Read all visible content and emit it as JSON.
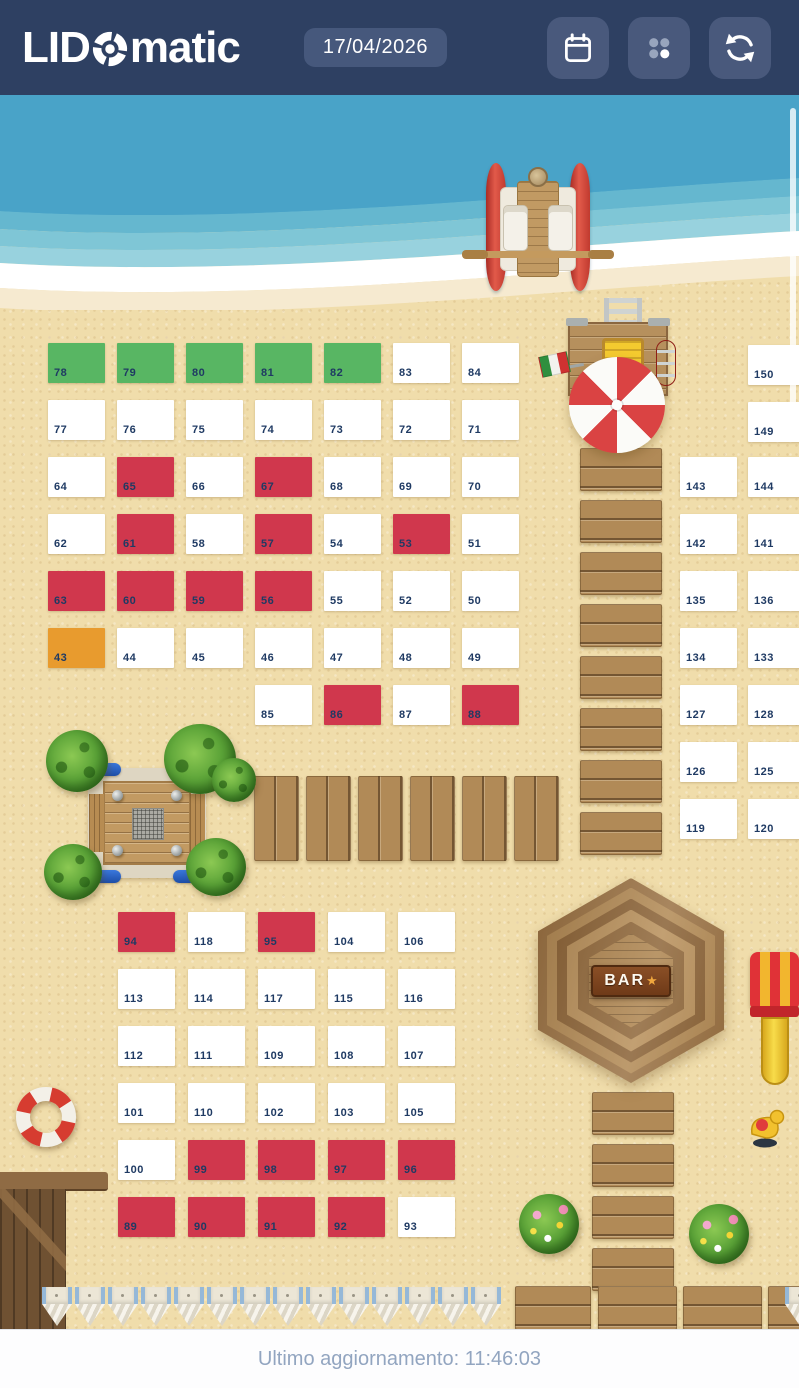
{
  "header": {
    "logo_prefix": "LID",
    "logo_suffix": "matic",
    "date": "17/04/2026",
    "buttons": [
      {
        "name": "calendar",
        "icon": "calendar-icon"
      },
      {
        "name": "grid-menu",
        "icon": "dots-grid-icon"
      },
      {
        "name": "refresh",
        "icon": "refresh-icon"
      }
    ]
  },
  "footer": {
    "last_update": "Ultimo aggiornamento: 11:46:03"
  },
  "bar": {
    "label": "BAR",
    "star": "★"
  },
  "colors": {
    "white": "#ffffff",
    "green": "#58b663",
    "red": "#d0374d",
    "orange": "#e89b2e",
    "header_bg": "#2e4062",
    "sand": "#f0ddab",
    "cell_text": "#1f3a63"
  },
  "map": {
    "cells": [
      {
        "n": "78",
        "x": 48,
        "y": 343,
        "s": "green"
      },
      {
        "n": "79",
        "x": 117,
        "y": 343,
        "s": "green"
      },
      {
        "n": "80",
        "x": 186,
        "y": 343,
        "s": "green"
      },
      {
        "n": "81",
        "x": 255,
        "y": 343,
        "s": "green"
      },
      {
        "n": "82",
        "x": 324,
        "y": 343,
        "s": "green"
      },
      {
        "n": "83",
        "x": 393,
        "y": 343,
        "s": "white"
      },
      {
        "n": "84",
        "x": 462,
        "y": 343,
        "s": "white"
      },
      {
        "n": "77",
        "x": 48,
        "y": 400,
        "s": "white"
      },
      {
        "n": "76",
        "x": 117,
        "y": 400,
        "s": "white"
      },
      {
        "n": "75",
        "x": 186,
        "y": 400,
        "s": "white"
      },
      {
        "n": "74",
        "x": 255,
        "y": 400,
        "s": "white"
      },
      {
        "n": "73",
        "x": 324,
        "y": 400,
        "s": "white"
      },
      {
        "n": "72",
        "x": 393,
        "y": 400,
        "s": "white"
      },
      {
        "n": "71",
        "x": 462,
        "y": 400,
        "s": "white"
      },
      {
        "n": "64",
        "x": 48,
        "y": 457,
        "s": "white"
      },
      {
        "n": "65",
        "x": 117,
        "y": 457,
        "s": "red"
      },
      {
        "n": "66",
        "x": 186,
        "y": 457,
        "s": "white"
      },
      {
        "n": "67",
        "x": 255,
        "y": 457,
        "s": "red"
      },
      {
        "n": "68",
        "x": 324,
        "y": 457,
        "s": "white"
      },
      {
        "n": "69",
        "x": 393,
        "y": 457,
        "s": "white"
      },
      {
        "n": "70",
        "x": 462,
        "y": 457,
        "s": "white"
      },
      {
        "n": "62",
        "x": 48,
        "y": 514,
        "s": "white"
      },
      {
        "n": "61",
        "x": 117,
        "y": 514,
        "s": "red"
      },
      {
        "n": "58",
        "x": 186,
        "y": 514,
        "s": "white"
      },
      {
        "n": "57",
        "x": 255,
        "y": 514,
        "s": "red"
      },
      {
        "n": "54",
        "x": 324,
        "y": 514,
        "s": "white"
      },
      {
        "n": "53",
        "x": 393,
        "y": 514,
        "s": "red"
      },
      {
        "n": "51",
        "x": 462,
        "y": 514,
        "s": "white"
      },
      {
        "n": "63",
        "x": 48,
        "y": 571,
        "s": "red"
      },
      {
        "n": "60",
        "x": 117,
        "y": 571,
        "s": "red"
      },
      {
        "n": "59",
        "x": 186,
        "y": 571,
        "s": "red"
      },
      {
        "n": "56",
        "x": 255,
        "y": 571,
        "s": "red"
      },
      {
        "n": "55",
        "x": 324,
        "y": 571,
        "s": "white"
      },
      {
        "n": "52",
        "x": 393,
        "y": 571,
        "s": "white"
      },
      {
        "n": "50",
        "x": 462,
        "y": 571,
        "s": "white"
      },
      {
        "n": "43",
        "x": 48,
        "y": 628,
        "s": "orange"
      },
      {
        "n": "44",
        "x": 117,
        "y": 628,
        "s": "white"
      },
      {
        "n": "45",
        "x": 186,
        "y": 628,
        "s": "white"
      },
      {
        "n": "46",
        "x": 255,
        "y": 628,
        "s": "white"
      },
      {
        "n": "47",
        "x": 324,
        "y": 628,
        "s": "white"
      },
      {
        "n": "48",
        "x": 393,
        "y": 628,
        "s": "white"
      },
      {
        "n": "49",
        "x": 462,
        "y": 628,
        "s": "white"
      },
      {
        "n": "85",
        "x": 255,
        "y": 685,
        "s": "white"
      },
      {
        "n": "86",
        "x": 324,
        "y": 685,
        "s": "red"
      },
      {
        "n": "87",
        "x": 393,
        "y": 685,
        "s": "white"
      },
      {
        "n": "88",
        "x": 462,
        "y": 685,
        "s": "red"
      },
      {
        "n": "143",
        "x": 680,
        "y": 457,
        "s": "white"
      },
      {
        "n": "142",
        "x": 680,
        "y": 514,
        "s": "white"
      },
      {
        "n": "135",
        "x": 680,
        "y": 571,
        "s": "white"
      },
      {
        "n": "134",
        "x": 680,
        "y": 628,
        "s": "white"
      },
      {
        "n": "127",
        "x": 680,
        "y": 685,
        "s": "white"
      },
      {
        "n": "126",
        "x": 680,
        "y": 742,
        "s": "white"
      },
      {
        "n": "119",
        "x": 680,
        "y": 799,
        "s": "white"
      },
      {
        "n": "150",
        "x": 748,
        "y": 345,
        "s": "white"
      },
      {
        "n": "149",
        "x": 748,
        "y": 402,
        "s": "white"
      },
      {
        "n": "144",
        "x": 748,
        "y": 457,
        "s": "white"
      },
      {
        "n": "141",
        "x": 748,
        "y": 514,
        "s": "white"
      },
      {
        "n": "136",
        "x": 748,
        "y": 571,
        "s": "white"
      },
      {
        "n": "133",
        "x": 748,
        "y": 628,
        "s": "white"
      },
      {
        "n": "128",
        "x": 748,
        "y": 685,
        "s": "white"
      },
      {
        "n": "125",
        "x": 748,
        "y": 742,
        "s": "white"
      },
      {
        "n": "120",
        "x": 748,
        "y": 799,
        "s": "white"
      },
      {
        "n": "94",
        "x": 118,
        "y": 912,
        "s": "red"
      },
      {
        "n": "118",
        "x": 188,
        "y": 912,
        "s": "white"
      },
      {
        "n": "95",
        "x": 258,
        "y": 912,
        "s": "red"
      },
      {
        "n": "104",
        "x": 328,
        "y": 912,
        "s": "white"
      },
      {
        "n": "106",
        "x": 398,
        "y": 912,
        "s": "white"
      },
      {
        "n": "113",
        "x": 118,
        "y": 969,
        "s": "white"
      },
      {
        "n": "114",
        "x": 188,
        "y": 969,
        "s": "white"
      },
      {
        "n": "117",
        "x": 258,
        "y": 969,
        "s": "white"
      },
      {
        "n": "115",
        "x": 328,
        "y": 969,
        "s": "white"
      },
      {
        "n": "116",
        "x": 398,
        "y": 969,
        "s": "white"
      },
      {
        "n": "112",
        "x": 118,
        "y": 1026,
        "s": "white"
      },
      {
        "n": "111",
        "x": 188,
        "y": 1026,
        "s": "white"
      },
      {
        "n": "109",
        "x": 258,
        "y": 1026,
        "s": "white"
      },
      {
        "n": "108",
        "x": 328,
        "y": 1026,
        "s": "white"
      },
      {
        "n": "107",
        "x": 398,
        "y": 1026,
        "s": "white"
      },
      {
        "n": "101",
        "x": 118,
        "y": 1083,
        "s": "white"
      },
      {
        "n": "110",
        "x": 188,
        "y": 1083,
        "s": "white"
      },
      {
        "n": "102",
        "x": 258,
        "y": 1083,
        "s": "white"
      },
      {
        "n": "103",
        "x": 328,
        "y": 1083,
        "s": "white"
      },
      {
        "n": "105",
        "x": 398,
        "y": 1083,
        "s": "white"
      },
      {
        "n": "100",
        "x": 118,
        "y": 1140,
        "s": "white"
      },
      {
        "n": "99",
        "x": 188,
        "y": 1140,
        "s": "red"
      },
      {
        "n": "98",
        "x": 258,
        "y": 1140,
        "s": "red"
      },
      {
        "n": "97",
        "x": 328,
        "y": 1140,
        "s": "red"
      },
      {
        "n": "96",
        "x": 398,
        "y": 1140,
        "s": "red"
      },
      {
        "n": "89",
        "x": 118,
        "y": 1197,
        "s": "red"
      },
      {
        "n": "90",
        "x": 188,
        "y": 1197,
        "s": "red"
      },
      {
        "n": "91",
        "x": 258,
        "y": 1197,
        "s": "red"
      },
      {
        "n": "92",
        "x": 328,
        "y": 1197,
        "s": "red"
      },
      {
        "n": "93",
        "x": 398,
        "y": 1197,
        "s": "white"
      }
    ]
  }
}
